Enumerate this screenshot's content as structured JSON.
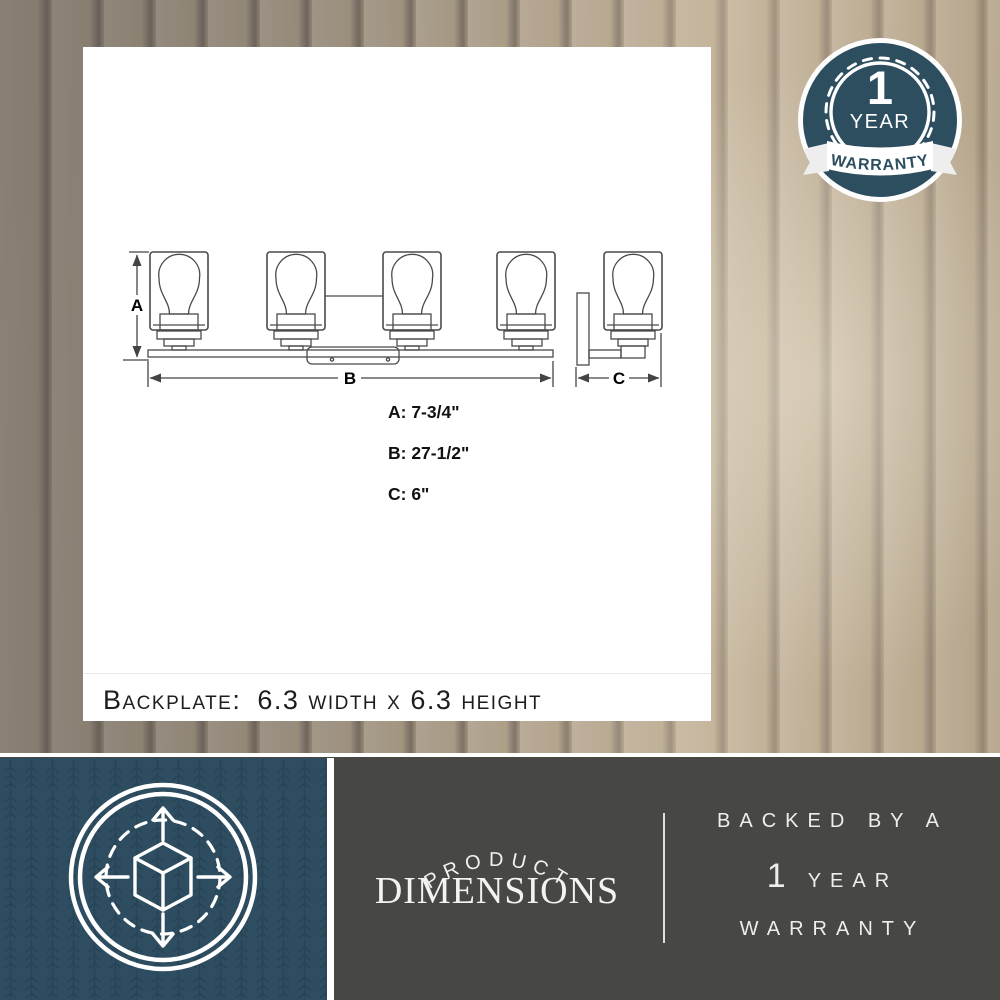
{
  "badge": {
    "value": "1",
    "unit": "YEAR",
    "ribbon": "WARRANTY"
  },
  "diagram": {
    "labels": {
      "a": "A",
      "b": "B",
      "c": "C"
    },
    "dimensions": [
      {
        "label": "A",
        "display": "A: 7-3/4\""
      },
      {
        "label": "B",
        "display": "B: 27-1/2\""
      },
      {
        "label": "C",
        "display": "C: 6\""
      }
    ],
    "backplate": {
      "label": "Backplate:",
      "value": "6.3 width x 6.3 height"
    }
  },
  "footer": {
    "arc_text": "PRODUCT",
    "title": "DIMENSIONS",
    "right": {
      "line1": "BACKED BY A",
      "year_num": "1",
      "year_word": "YEAR",
      "line3": "WARRANTY"
    },
    "icon": "3d-box-dimensions-icon"
  },
  "colors": {
    "brand_teal": "#2e4d60",
    "footer_gray": "#474744",
    "panel": "#ffffff",
    "line": "#444444"
  }
}
